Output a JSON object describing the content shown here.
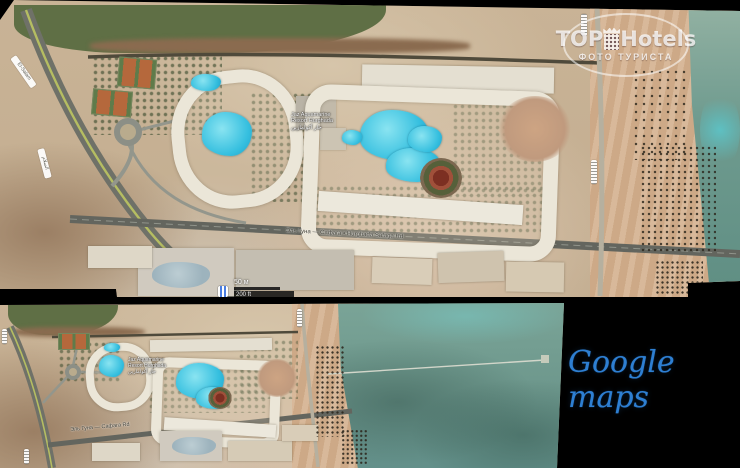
{
  "watermark": {
    "top": "TOP",
    "hotels": "Hotels",
    "subtitle": "ФОТО ТУРИСТА",
    "building_icon": "hotel-tower-with-crown-icon"
  },
  "caption": {
    "text": "Google maps",
    "color": "#2e7fd2"
  },
  "top_map": {
    "labels": {
      "el_salam": "El-Salam",
      "el_salam_ar": "السلام",
      "main_road": "Эль Гуна — Сафага • Hurghada Safaga Rd"
    },
    "hotel_label": {
      "lines": [
        "Jaz Aquamarine",
        "Resort Hurghada",
        "جاز أكوامارين"
      ]
    },
    "scale": {
      "metric": "50 м",
      "imperial": "200 ft"
    },
    "poi_icon": "map-poi-icon"
  },
  "bottom_map": {
    "labels": {
      "main_road": "Эль Гуна — Сафага Rd"
    },
    "hotel_label": {
      "lines": [
        "Jaz Aquamarine",
        "Resort Hurghada",
        "جاز أكوامارين"
      ]
    }
  },
  "colors": {
    "pool": "#35bfdf",
    "sea": "#6e988d",
    "sand": "#c9b396",
    "lagoon": "#5f6f45",
    "background": "#000000"
  }
}
